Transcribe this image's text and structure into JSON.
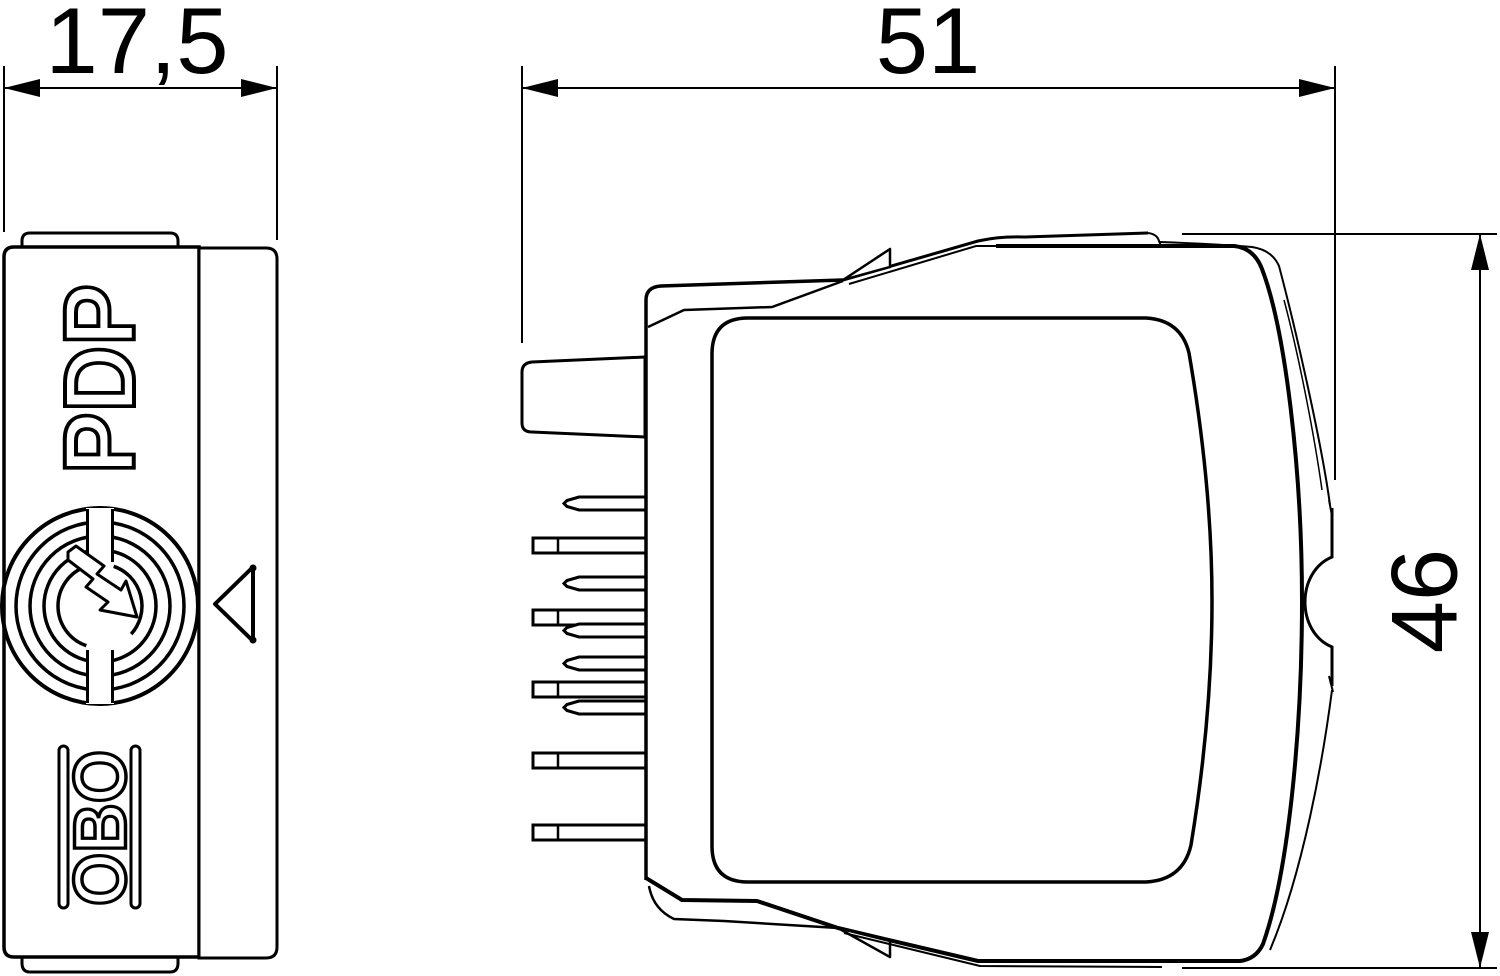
{
  "drawing": {
    "type": "technical-dimension-drawing",
    "views": {
      "front": "front view",
      "side": "side view"
    },
    "dimensions": {
      "width_front": "17,5",
      "width_side": "51",
      "height_side": "46"
    },
    "labels": {
      "product": "PDP",
      "brand": "OBO"
    },
    "icons": {
      "surge_arrester": "circle-lightning-bolt",
      "direction_marker": "triangle-left"
    },
    "colors": {
      "line": "#000000",
      "background": "#ffffff"
    }
  }
}
